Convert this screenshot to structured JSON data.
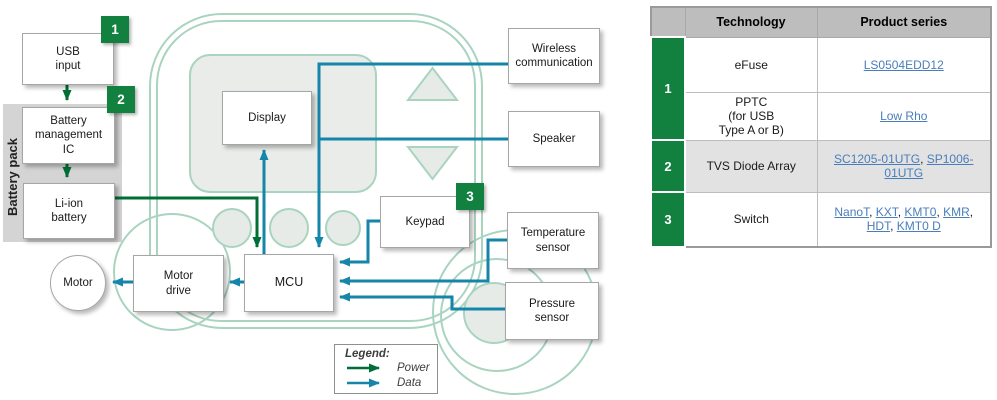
{
  "diagram": {
    "badges": {
      "b1": "1",
      "b2": "2",
      "b3": "3"
    },
    "battery_pack_label": "Battery pack",
    "nodes": {
      "usb_input": "USB\ninput",
      "battery_management_ic": "Battery\nmanagement\nIC",
      "li_ion_battery": "Li-ion\nbattery",
      "motor": "Motor",
      "motor_drive": "Motor\ndrive",
      "mcu": "MCU",
      "display": "Display",
      "keypad": "Keypad",
      "wireless_communication": "Wireless\ncommunication",
      "speaker": "Speaker",
      "temperature_sensor": "Temperature\nsensor",
      "pressure_sensor": "Pressure\nsensor"
    },
    "legend": {
      "title": "Legend:",
      "power_label": "Power",
      "data_label": "Data"
    }
  },
  "table": {
    "headers": {
      "number": "",
      "technology": "Technology",
      "product_series": "Product series"
    },
    "rows": [
      {
        "number": "1",
        "technology": "eFuse",
        "links": [
          "LS0504EDD12"
        ]
      },
      {
        "technology": "PPTC\n(for USB\nType A or B)",
        "links": [
          "Low Rho"
        ]
      },
      {
        "number": "2",
        "technology": "TVS Diode Array",
        "links": [
          "SC1205-01UTG",
          "SP1006-01UTG"
        ]
      },
      {
        "number": "3",
        "technology": "Switch",
        "links": [
          "NanoT",
          "KXT",
          "KMT0",
          "KMR",
          "HDT",
          "KMT0 D"
        ]
      }
    ]
  },
  "colors": {
    "power_green": "#006f35",
    "data_teal": "#1585aa",
    "badge_green": "#12813f",
    "link_blue": "#4a7ebb",
    "device_outline": "#a9d4bf",
    "header_gray": "#bdbdbd"
  }
}
